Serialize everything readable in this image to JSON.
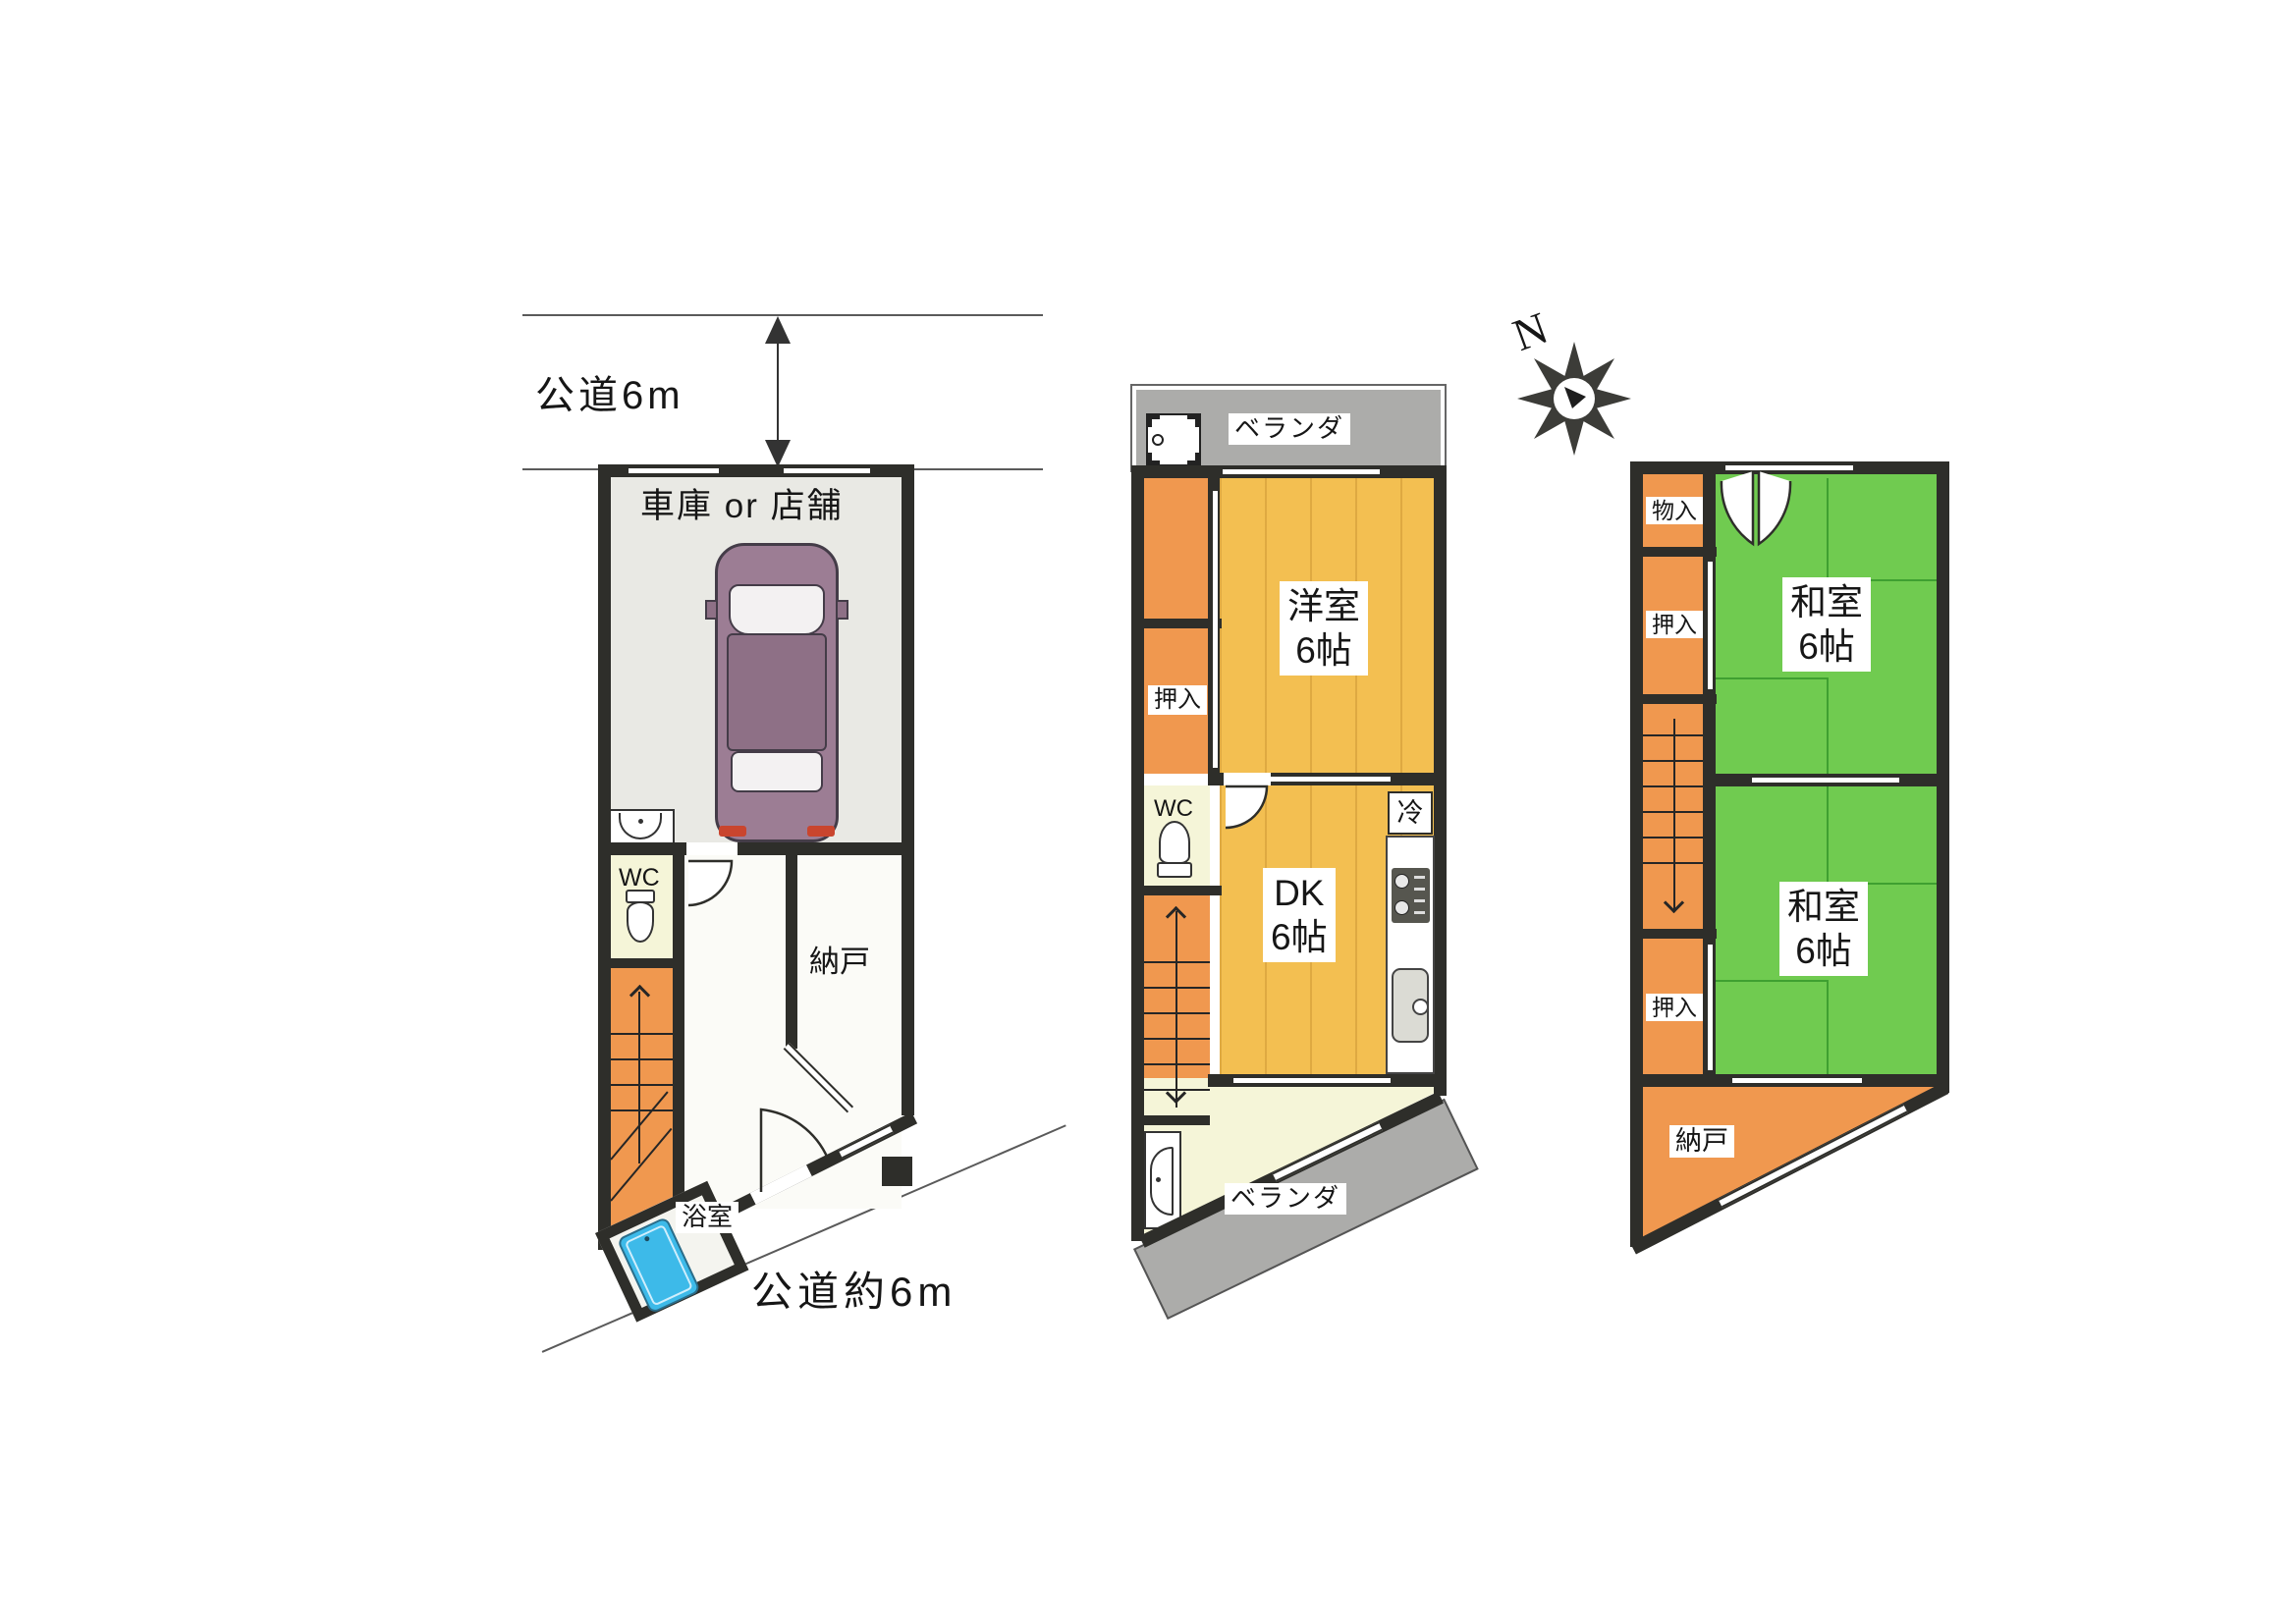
{
  "roads": {
    "top_label": "公道6m",
    "bottom_label": "公道約6m"
  },
  "compass": {
    "north": "N"
  },
  "floor1": {
    "garage": "車庫 or 店舗",
    "wc": "WC",
    "storage": "納戸",
    "bath": "浴室"
  },
  "floor2": {
    "veranda_top": "ベランダ",
    "western_room": "洋室",
    "western_room_size": "6帖",
    "closet": "押入",
    "wc": "WC",
    "dk": "DK",
    "dk_size": "6帖",
    "fridge": "冷",
    "veranda_bottom": "ベランダ"
  },
  "floor3": {
    "small_storage": "物入",
    "closet_upper": "押入",
    "japanese_room1": "和室",
    "japanese_room1_size": "6帖",
    "closet_lower": "押入",
    "japanese_room2": "和室",
    "japanese_room2_size": "6帖",
    "storage": "納戸"
  },
  "icons": {
    "car": "car-top-view-icon",
    "toilet": "toilet-icon",
    "washbasin": "washbasin-icon",
    "bathtub": "bathtub-icon",
    "washing_machine": "washing-machine-icon",
    "stove": "gas-stove-icon",
    "kitchen_sink": "kitchen-sink-icon",
    "refrigerator": "refrigerator-box",
    "compass": "compass-rose-icon"
  },
  "colors": {
    "wall": "#2E2E2A",
    "tatami_green": "#70CB50",
    "wood_yellow": "#F3BF51",
    "closet_orange": "#F0984F",
    "cream": "#F5F5D8",
    "veranda_gray": "#ACACAA",
    "garage_gray": "#E9E9E4",
    "bath_blue": "#3DBAE9"
  }
}
